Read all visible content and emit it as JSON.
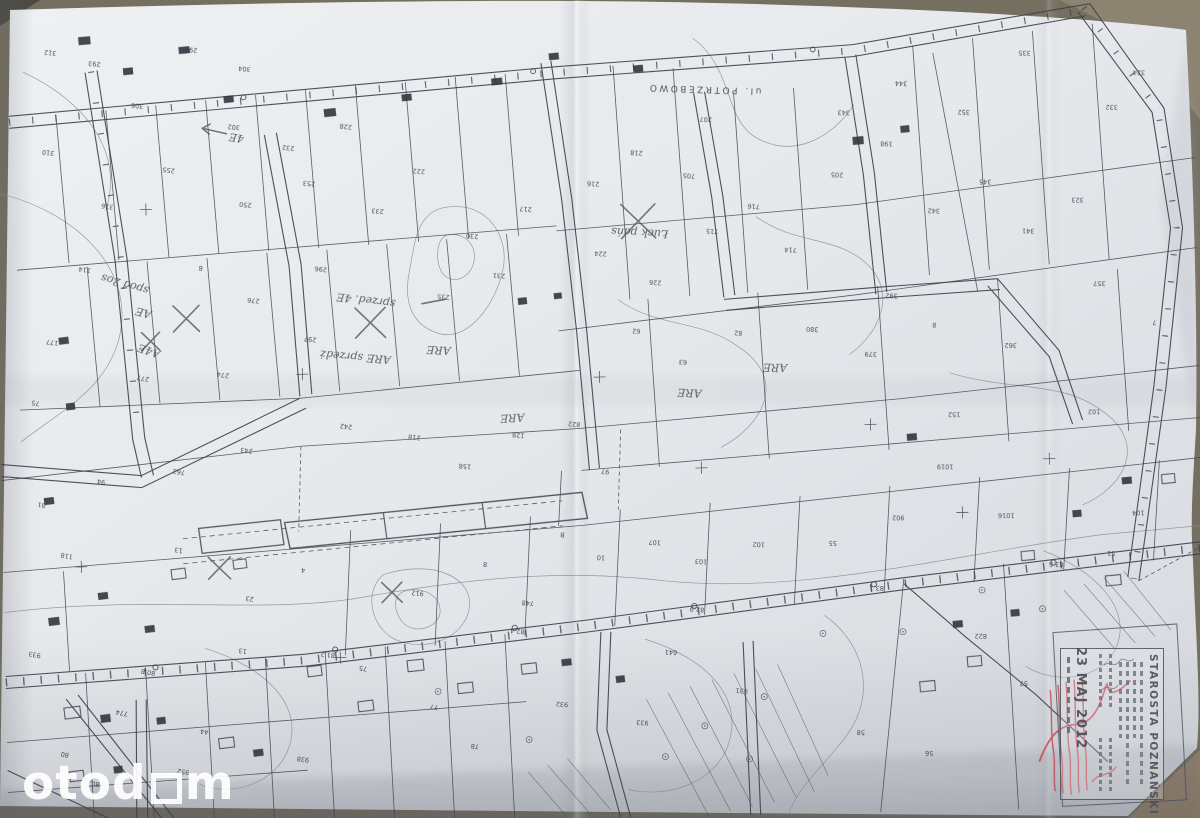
{
  "photo": {
    "watermark": {
      "pre": "otod",
      "post": "m"
    },
    "colors": {
      "paper": "#e9ebee",
      "map_ink": "#3d434d",
      "table_background": "#6f6a5c",
      "stamp_ink": "#4a4f57",
      "stamp_red": "#c2414d",
      "watermark": "#ffffff"
    }
  },
  "stamp": {
    "org": "STAROSTA POZNAŃSKI",
    "date": "23 MAJ 2012"
  },
  "map_labels": {
    "street": [
      {
        "t": "ul. POTRZEBOWO",
        "x": 768,
        "y": 92,
        "r": 183,
        "s": 9
      }
    ],
    "handwritten": [
      {
        "t": "sprzed. 4E",
        "x": 398,
        "y": 296,
        "r": 188
      },
      {
        "t": "ARE sprzedż",
        "x": 392,
        "y": 352,
        "r": 186
      },
      {
        "t": "spod 2os",
        "x": 152,
        "y": 278,
        "r": 197
      },
      {
        "t": "Łuck pańs",
        "x": 672,
        "y": 232,
        "r": 184
      },
      {
        "t": "ARE",
        "x": 452,
        "y": 344,
        "r": 184
      },
      {
        "t": "ARE",
        "x": 524,
        "y": 412,
        "r": 178
      },
      {
        "t": "ARE",
        "x": 702,
        "y": 392,
        "r": 184
      },
      {
        "t": "ARE",
        "x": 788,
        "y": 368,
        "r": 182
      },
      {
        "t": "A4E",
        "x": 162,
        "y": 342,
        "r": 200
      },
      {
        "t": "AE",
        "x": 154,
        "y": 302,
        "r": 196
      },
      {
        "t": "4E",
        "x": 250,
        "y": 128,
        "r": 190
      }
    ],
    "numbers": [
      {
        "t": "312",
        "x": 64,
        "y": 40,
        "r": 187
      },
      {
        "t": "293",
        "x": 108,
        "y": 52,
        "r": 187
      },
      {
        "t": "297",
        "x": 205,
        "y": 40,
        "r": 187
      },
      {
        "t": "304",
        "x": 258,
        "y": 60,
        "r": 186
      },
      {
        "t": "306",
        "x": 150,
        "y": 95,
        "r": 188
      },
      {
        "t": "302",
        "x": 246,
        "y": 118,
        "r": 186
      },
      {
        "t": "310",
        "x": 60,
        "y": 140,
        "r": 188
      },
      {
        "t": "255",
        "x": 180,
        "y": 160,
        "r": 188
      },
      {
        "t": "316",
        "x": 118,
        "y": 195,
        "r": 189
      },
      {
        "t": "250",
        "x": 256,
        "y": 196,
        "r": 187
      },
      {
        "t": "253",
        "x": 320,
        "y": 176,
        "r": 186
      },
      {
        "t": "114",
        "x": 94,
        "y": 258,
        "r": 190
      },
      {
        "t": "8",
        "x": 206,
        "y": 258,
        "r": 189
      },
      {
        "t": "276",
        "x": 262,
        "y": 292,
        "r": 188
      },
      {
        "t": "296",
        "x": 330,
        "y": 262,
        "r": 187
      },
      {
        "t": "277",
        "x": 150,
        "y": 368,
        "r": 191
      },
      {
        "t": "274",
        "x": 230,
        "y": 366,
        "r": 190
      },
      {
        "t": "297",
        "x": 318,
        "y": 332,
        "r": 188
      },
      {
        "t": "177",
        "x": 60,
        "y": 330,
        "r": 190
      },
      {
        "t": "75",
        "x": 40,
        "y": 390,
        "r": 190
      },
      {
        "t": "233",
        "x": 388,
        "y": 205,
        "r": 186
      },
      {
        "t": "222",
        "x": 430,
        "y": 166,
        "r": 186
      },
      {
        "t": "232",
        "x": 300,
        "y": 140,
        "r": 187
      },
      {
        "t": "228",
        "x": 358,
        "y": 120,
        "r": 187
      },
      {
        "t": "230",
        "x": 482,
        "y": 232,
        "r": 185
      },
      {
        "t": "231",
        "x": 508,
        "y": 272,
        "r": 185
      },
      {
        "t": "235",
        "x": 452,
        "y": 292,
        "r": 185
      },
      {
        "t": "217",
        "x": 536,
        "y": 206,
        "r": 185
      },
      {
        "t": "216",
        "x": 604,
        "y": 182,
        "r": 184
      },
      {
        "t": "218",
        "x": 648,
        "y": 152,
        "r": 184
      },
      {
        "t": "224",
        "x": 610,
        "y": 252,
        "r": 184
      },
      {
        "t": "226",
        "x": 664,
        "y": 282,
        "r": 184
      },
      {
        "t": "705",
        "x": 700,
        "y": 176,
        "r": 184
      },
      {
        "t": "715",
        "x": 722,
        "y": 232,
        "r": 184
      },
      {
        "t": "716",
        "x": 764,
        "y": 208,
        "r": 184
      },
      {
        "t": "714",
        "x": 800,
        "y": 252,
        "r": 183
      },
      {
        "t": "207",
        "x": 718,
        "y": 120,
        "r": 184
      },
      {
        "t": "205",
        "x": 848,
        "y": 178,
        "r": 183
      },
      {
        "t": "198",
        "x": 898,
        "y": 148,
        "r": 183
      },
      {
        "t": "342",
        "x": 944,
        "y": 216,
        "r": 183
      },
      {
        "t": "345",
        "x": 996,
        "y": 188,
        "r": 182
      },
      {
        "t": "341",
        "x": 1038,
        "y": 238,
        "r": 182
      },
      {
        "t": "323",
        "x": 1088,
        "y": 208,
        "r": 182
      },
      {
        "t": "332",
        "x": 1124,
        "y": 116,
        "r": 182
      },
      {
        "t": "324",
        "x": 1152,
        "y": 82,
        "r": 182
      },
      {
        "t": "352",
        "x": 976,
        "y": 118,
        "r": 183
      },
      {
        "t": "344",
        "x": 914,
        "y": 88,
        "r": 183
      },
      {
        "t": "343",
        "x": 856,
        "y": 116,
        "r": 183
      },
      {
        "t": "335",
        "x": 1038,
        "y": 60,
        "r": 182
      },
      {
        "t": "357",
        "x": 1108,
        "y": 292,
        "r": 182
      },
      {
        "t": "7",
        "x": 1158,
        "y": 332,
        "r": 181
      },
      {
        "t": "362",
        "x": 1018,
        "y": 352,
        "r": 182
      },
      {
        "t": "8",
        "x": 938,
        "y": 330,
        "r": 183
      },
      {
        "t": "379",
        "x": 878,
        "y": 358,
        "r": 183
      },
      {
        "t": "380",
        "x": 820,
        "y": 332,
        "r": 183
      },
      {
        "t": "392",
        "x": 900,
        "y": 300,
        "r": 183
      },
      {
        "t": "62",
        "x": 642,
        "y": 330,
        "r": 184
      },
      {
        "t": "63",
        "x": 688,
        "y": 362,
        "r": 184
      },
      {
        "t": "82",
        "x": 744,
        "y": 334,
        "r": 184
      },
      {
        "t": "242",
        "x": 352,
        "y": 420,
        "r": 188
      },
      {
        "t": "218",
        "x": 420,
        "y": 432,
        "r": 187
      },
      {
        "t": "158",
        "x": 470,
        "y": 462,
        "r": 186
      },
      {
        "t": "128",
        "x": 524,
        "y": 432,
        "r": 186
      },
      {
        "t": "822",
        "x": 580,
        "y": 422,
        "r": 185
      },
      {
        "t": "243",
        "x": 252,
        "y": 442,
        "r": 189
      },
      {
        "t": "763",
        "x": 184,
        "y": 462,
        "r": 190
      },
      {
        "t": "94",
        "x": 104,
        "y": 470,
        "r": 191
      },
      {
        "t": "81",
        "x": 44,
        "y": 492,
        "r": 191
      },
      {
        "t": "97",
        "x": 608,
        "y": 470,
        "r": 185
      },
      {
        "t": "152",
        "x": 960,
        "y": 420,
        "r": 182
      },
      {
        "t": "102",
        "x": 1100,
        "y": 420,
        "r": 181
      },
      {
        "t": "4",
        "x": 302,
        "y": 562,
        "r": 188
      },
      {
        "t": "8",
        "x": 484,
        "y": 560,
        "r": 186
      },
      {
        "t": "B",
        "x": 562,
        "y": 532,
        "r": 185
      },
      {
        "t": "10",
        "x": 602,
        "y": 556,
        "r": 185
      },
      {
        "t": "107",
        "x": 658,
        "y": 542,
        "r": 184
      },
      {
        "t": "103",
        "x": 704,
        "y": 562,
        "r": 184
      },
      {
        "t": "102",
        "x": 762,
        "y": 546,
        "r": 183
      },
      {
        "t": "55",
        "x": 834,
        "y": 546,
        "r": 183
      },
      {
        "t": "902",
        "x": 902,
        "y": 522,
        "r": 182
      },
      {
        "t": "1019",
        "x": 952,
        "y": 472,
        "r": 182
      },
      {
        "t": "1016",
        "x": 1012,
        "y": 522,
        "r": 181
      },
      {
        "t": "104",
        "x": 1142,
        "y": 522,
        "r": 181
      },
      {
        "t": "51",
        "x": 1112,
        "y": 562,
        "r": 181
      },
      {
        "t": "118",
        "x": 70,
        "y": 544,
        "r": 191
      },
      {
        "t": "13",
        "x": 180,
        "y": 540,
        "r": 190
      },
      {
        "t": "23",
        "x": 250,
        "y": 590,
        "r": 189
      },
      {
        "t": "912",
        "x": 420,
        "y": 588,
        "r": 187
      },
      {
        "t": "748",
        "x": 530,
        "y": 600,
        "r": 186
      },
      {
        "t": "58",
        "x": 858,
        "y": 736,
        "r": 183
      },
      {
        "t": "56",
        "x": 926,
        "y": 758,
        "r": 183
      },
      {
        "t": "57",
        "x": 1022,
        "y": 690,
        "r": 182
      },
      {
        "t": "77",
        "x": 432,
        "y": 702,
        "r": 187
      },
      {
        "t": "78",
        "x": 472,
        "y": 742,
        "r": 187
      },
      {
        "t": "932",
        "x": 562,
        "y": 702,
        "r": 186
      },
      {
        "t": "933",
        "x": 642,
        "y": 722,
        "r": 185
      },
      {
        "t": "44",
        "x": 202,
        "y": 722,
        "r": 190
      },
      {
        "t": "774",
        "x": 122,
        "y": 702,
        "r": 191
      },
      {
        "t": "80",
        "x": 62,
        "y": 742,
        "r": 191
      },
      {
        "t": "938",
        "x": 302,
        "y": 752,
        "r": 189
      },
      {
        "t": "952",
        "x": 182,
        "y": 762,
        "r": 190
      },
      {
        "t": "802",
        "x": 92,
        "y": 772,
        "r": 191
      },
      {
        "t": "931",
        "x": 742,
        "y": 692,
        "r": 184
      },
      {
        "t": "822",
        "x": 982,
        "y": 642,
        "r": 182
      },
      {
        "t": "933",
        "x": 36,
        "y": 642,
        "r": 192
      },
      {
        "t": "13",
        "x": 242,
        "y": 642,
        "r": 189
      },
      {
        "t": "75",
        "x": 362,
        "y": 662,
        "r": 188
      },
      {
        "t": "641",
        "x": 672,
        "y": 652,
        "r": 184
      },
      {
        "t": "81.2",
        "x": 330,
        "y": 648,
        "r": 189,
        "s": 4.8
      },
      {
        "t": "82.4",
        "x": 520,
        "y": 628,
        "r": 186,
        "s": 4.8
      },
      {
        "t": "82.9",
        "x": 700,
        "y": 610,
        "r": 185,
        "s": 4.8
      },
      {
        "t": "83.1",
        "x": 880,
        "y": 592,
        "r": 183,
        "s": 4.8
      },
      {
        "t": "83.6",
        "x": 1060,
        "y": 572,
        "r": 182,
        "s": 4.8
      },
      {
        "t": "80.8",
        "x": 150,
        "y": 662,
        "r": 191,
        "s": 4.8
      }
    ]
  }
}
